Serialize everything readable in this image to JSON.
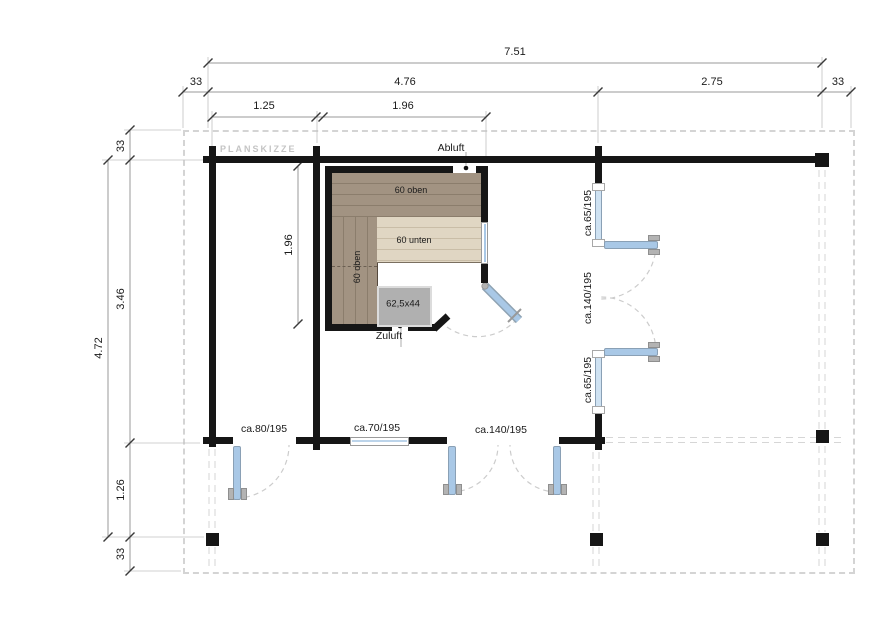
{
  "plan": {
    "title": "PLANSKIZZE",
    "labels": {
      "abluft": "Abluft",
      "zuluft": "Zuluft",
      "bench_top": "60 oben",
      "bench_left": "60 oben",
      "bench_lower": "60 unten",
      "heater": "62,5x44"
    },
    "openings": {
      "right_panel_top": "ca.65/195",
      "right_double_door": "ca.140/195",
      "right_panel_bottom": "ca.65/195",
      "front_door": "ca.80/195",
      "front_window": "ca.70/195",
      "front_double_door": "ca.140/195"
    },
    "dims": {
      "total_width": "7.51",
      "overhang_left": "33",
      "width_main": "4.76",
      "width_right": "2.75",
      "overhang_right": "33",
      "room_left_width": "1.25",
      "sauna_width": "1.96",
      "total_height": "4.72",
      "overhang_top": "33",
      "height_main": "3.46",
      "porch_depth": "1.26",
      "overhang_bottom": "33",
      "sauna_height": "1.96"
    },
    "colors": {
      "wall": "#161616",
      "bench_dark": "#a29382",
      "bench_light": "#e0d6c3",
      "heater": "#b0b0b0",
      "glass_blue": "#a9c8e6",
      "roof_dash": "#d4d4d4"
    }
  }
}
